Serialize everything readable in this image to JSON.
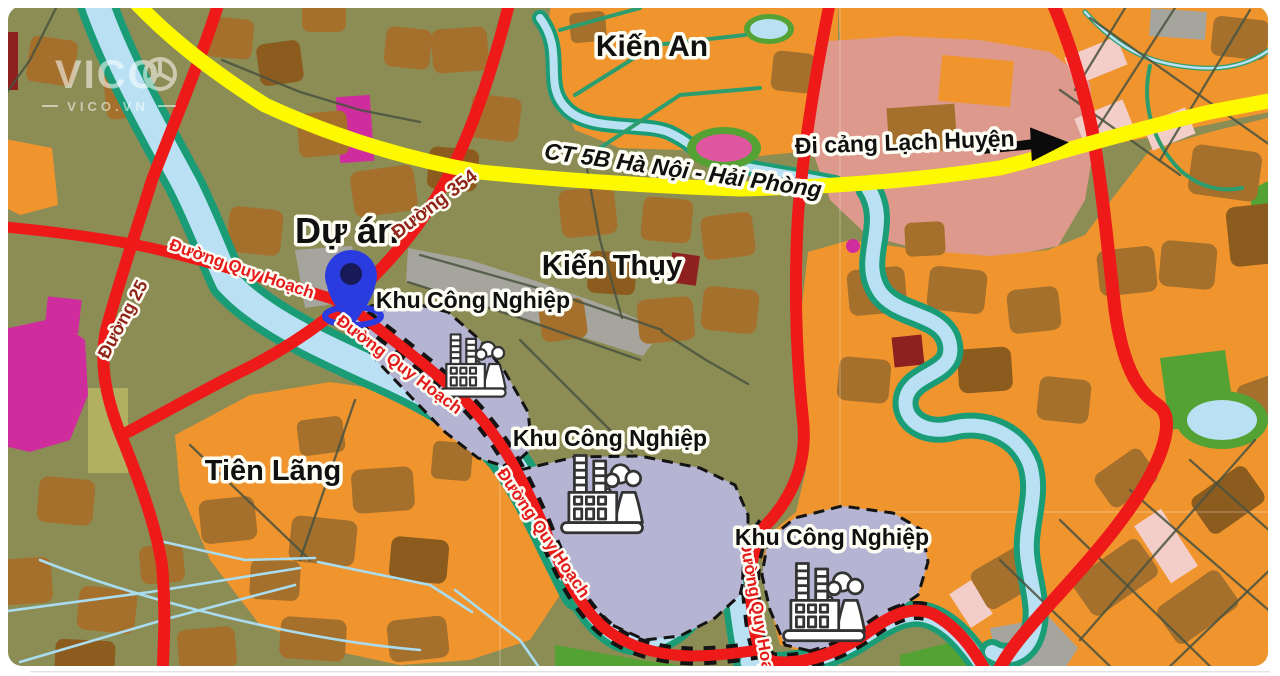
{
  "watermark": {
    "line1": "VICO",
    "line2": "VICO.VN"
  },
  "labels": {
    "kien_an": "Kiến An",
    "highway": "CT 5B Hà Nội - Hải Phòng",
    "lach_huyen": "Đi cảng Lạch Huyện",
    "du_an": "Dự án",
    "duong_354": "Đường 354",
    "duong_25": "Đường 25",
    "duong_quy_hoach": "Đường Quy Hoạch",
    "kien_thuy": "Kiến Thụy",
    "khu_cong_nghiep": "Khu Công Nghiệp",
    "tien_lang": "Tiên Lãng"
  },
  "palette": {
    "base_olive": "#8c8c55",
    "orange": "#f0952e",
    "brown": "#a4702c",
    "brown_dark": "#8c5c1f",
    "salmon": "#dc998c",
    "pink_pale": "#f3cdc8",
    "magenta": "#cf2d9d",
    "pink_pond": "#e0559f",
    "gray_zone": "#a6a59d",
    "lavender": "#b5b4d2",
    "river_blue": "#b9e1f3",
    "river_teal": "#1a9d77",
    "green": "#54a233",
    "yellow_green": "#b0b060",
    "road_red": "#ee1a1a",
    "highway_yellow": "#fdf900",
    "road_minor": "#49523f",
    "road_teal": "#2e9d6e",
    "stream": "#aadcf0",
    "label_black": "#101010",
    "label_red": "#e31b1b",
    "label_maroon": "#8f241b",
    "pin_blue": "#2a3ce0",
    "pin_core": "#171a56",
    "maroon_block": "#8e2020"
  }
}
